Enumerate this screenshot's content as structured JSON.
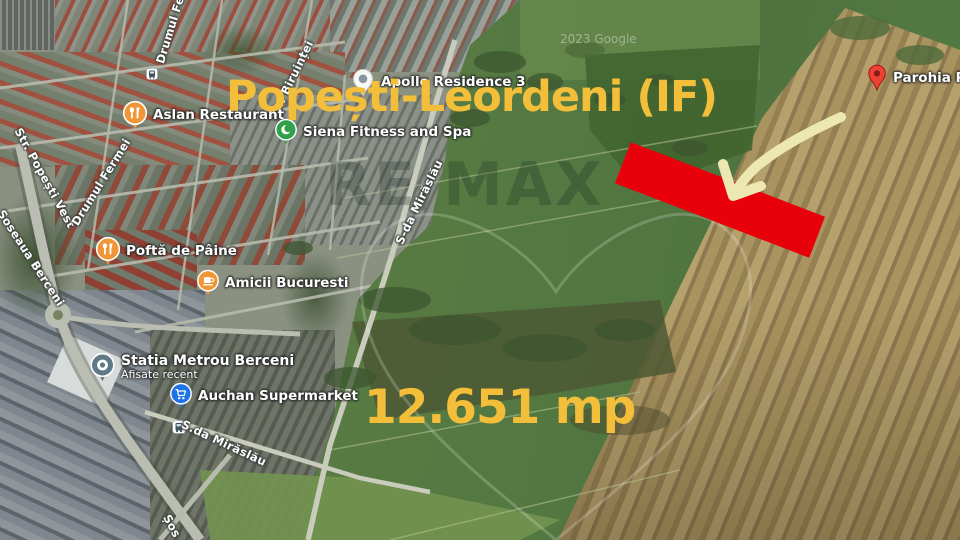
{
  "title": {
    "text": "Popești-Leordeni (IF)",
    "color": "#F3BE3A"
  },
  "area_label": {
    "text": "12.651 mp",
    "color": "#F3BE3A"
  },
  "highlight": {
    "kind": "plot-rectangle",
    "color": "#E8000B"
  },
  "arrow": {
    "kind": "curved-arrow",
    "color": "#EDE7B1"
  },
  "watermark": {
    "brand": "RE/MAX",
    "credit": "2023 Google"
  },
  "pois": [
    {
      "name": "Apollo Residence 3",
      "icon": "residence-pin"
    },
    {
      "name": "Aslan Restaurant",
      "icon": "restaurant-pin"
    },
    {
      "name": "Siena Fitness and Spa",
      "icon": "fitness-pin"
    },
    {
      "name": "Poftă de Pâine",
      "icon": "restaurant-pin"
    },
    {
      "name": "Amicii Bucuresti",
      "icon": "cafe-pin"
    },
    {
      "name": "Statia Metrou Berceni",
      "subtitle": "Afisate recent",
      "icon": "metro-pin"
    },
    {
      "name": "Auchan Supermarket",
      "icon": "supermarket-pin"
    },
    {
      "name": "Parohia Pop",
      "icon": "destination-pin"
    }
  ],
  "streets": [
    "Drumul Fe",
    "Str. Biruinței",
    "Str. Popești Vest",
    "Drumul Fermei",
    "Șoseaua Berceni",
    "S-da Mirăslău",
    "S.da Mirăslău",
    "Șos"
  ]
}
